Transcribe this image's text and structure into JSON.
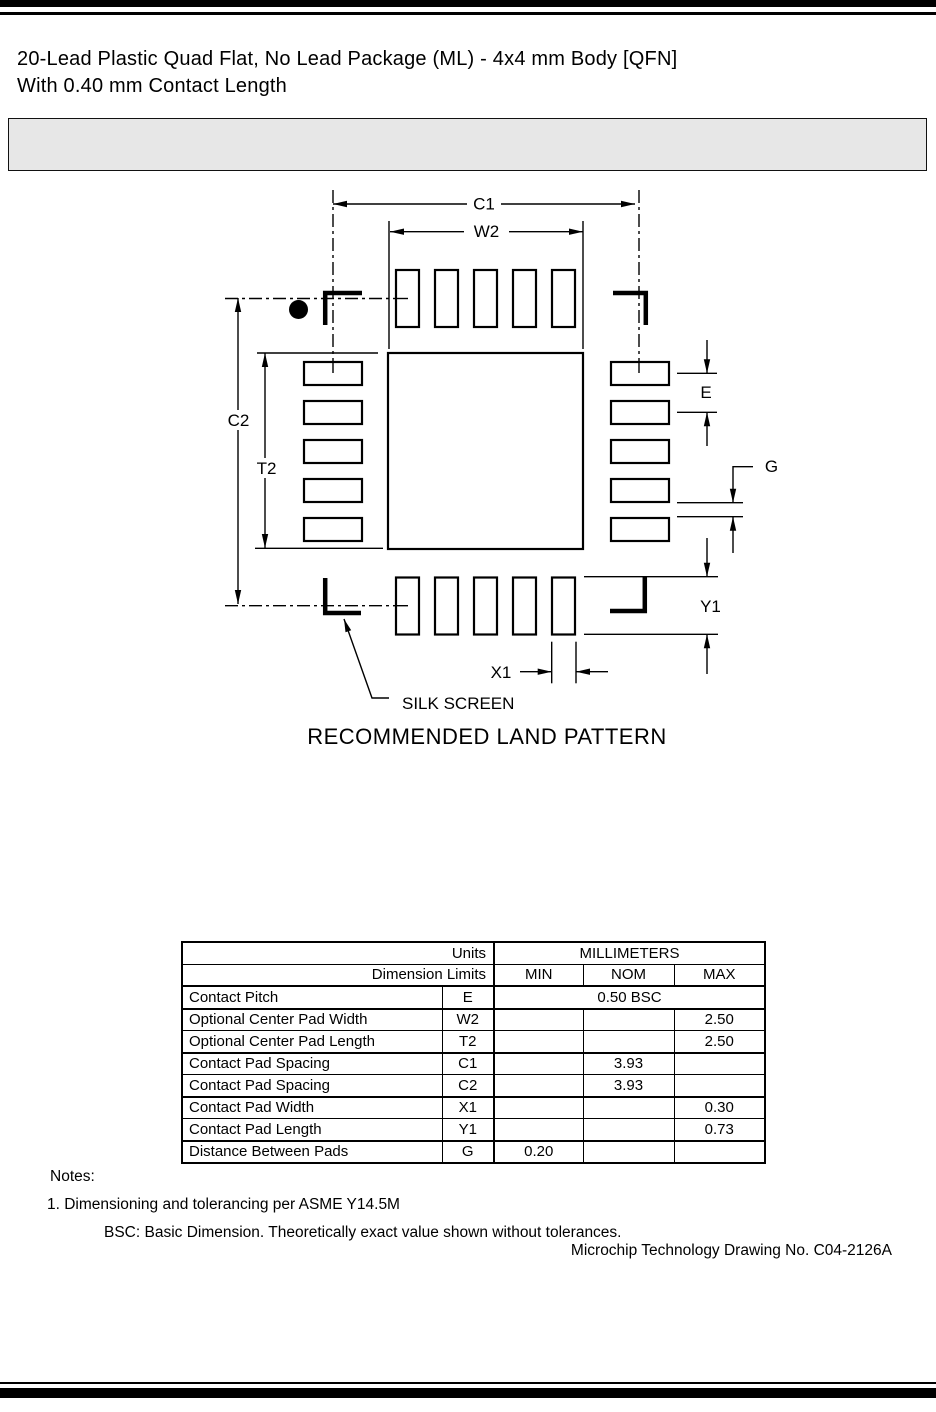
{
  "page": {
    "title_line1": "20-Lead Plastic Quad Flat, No Lead Package (ML) - 4x4 mm Body [QFN]",
    "title_line2": "With 0.40 mm Contact Length"
  },
  "colors": {
    "rule": "#000000",
    "placeholder_box": "#e7e7e7",
    "ink": "#000000"
  },
  "drawing": {
    "caption": "RECOMMENDED LAND PATTERN",
    "labels": {
      "c1": "C1",
      "w2": "W2",
      "c2": "C2",
      "t2": "T2",
      "e": "E",
      "g": "G",
      "y1": "Y1",
      "x1": "X1",
      "silk_screen": "SILK SCREEN"
    }
  },
  "table": {
    "header": {
      "units_label": "Units",
      "units_value": "MILLIMETERS",
      "limits_label": "Dimension Limits",
      "min": "MIN",
      "nom": "NOM",
      "max": "MAX"
    },
    "rows": [
      {
        "name": "Contact Pitch",
        "symbol": "E",
        "span_value": "0.50 BSC"
      },
      {
        "name": "Optional Center Pad Width",
        "symbol": "W2",
        "min": "",
        "nom": "",
        "max": "2.50"
      },
      {
        "name": "Optional Center Pad Length",
        "symbol": "T2",
        "min": "",
        "nom": "",
        "max": "2.50"
      },
      {
        "name": "Contact Pad Spacing",
        "symbol": "C1",
        "min": "",
        "nom": "3.93",
        "max": ""
      },
      {
        "name": "Contact Pad Spacing",
        "symbol": "C2",
        "min": "",
        "nom": "3.93",
        "max": ""
      },
      {
        "name": "Contact Pad Width",
        "symbol": "X1",
        "min": "",
        "nom": "",
        "max": "0.30"
      },
      {
        "name": "Contact Pad Length",
        "symbol": "Y1",
        "min": "",
        "nom": "",
        "max": "0.73"
      },
      {
        "name": "Distance Between Pads",
        "symbol": "G",
        "min": "0.20",
        "nom": "",
        "max": ""
      }
    ]
  },
  "notes": {
    "heading": "Notes:",
    "note1": "1. Dimensioning and tolerancing per ASME Y14.5M",
    "note2": "BSC: Basic Dimension. Theoretically exact value shown without tolerances."
  },
  "footer": {
    "drawing_no": "Microchip Technology Drawing No. C04-2126A"
  }
}
